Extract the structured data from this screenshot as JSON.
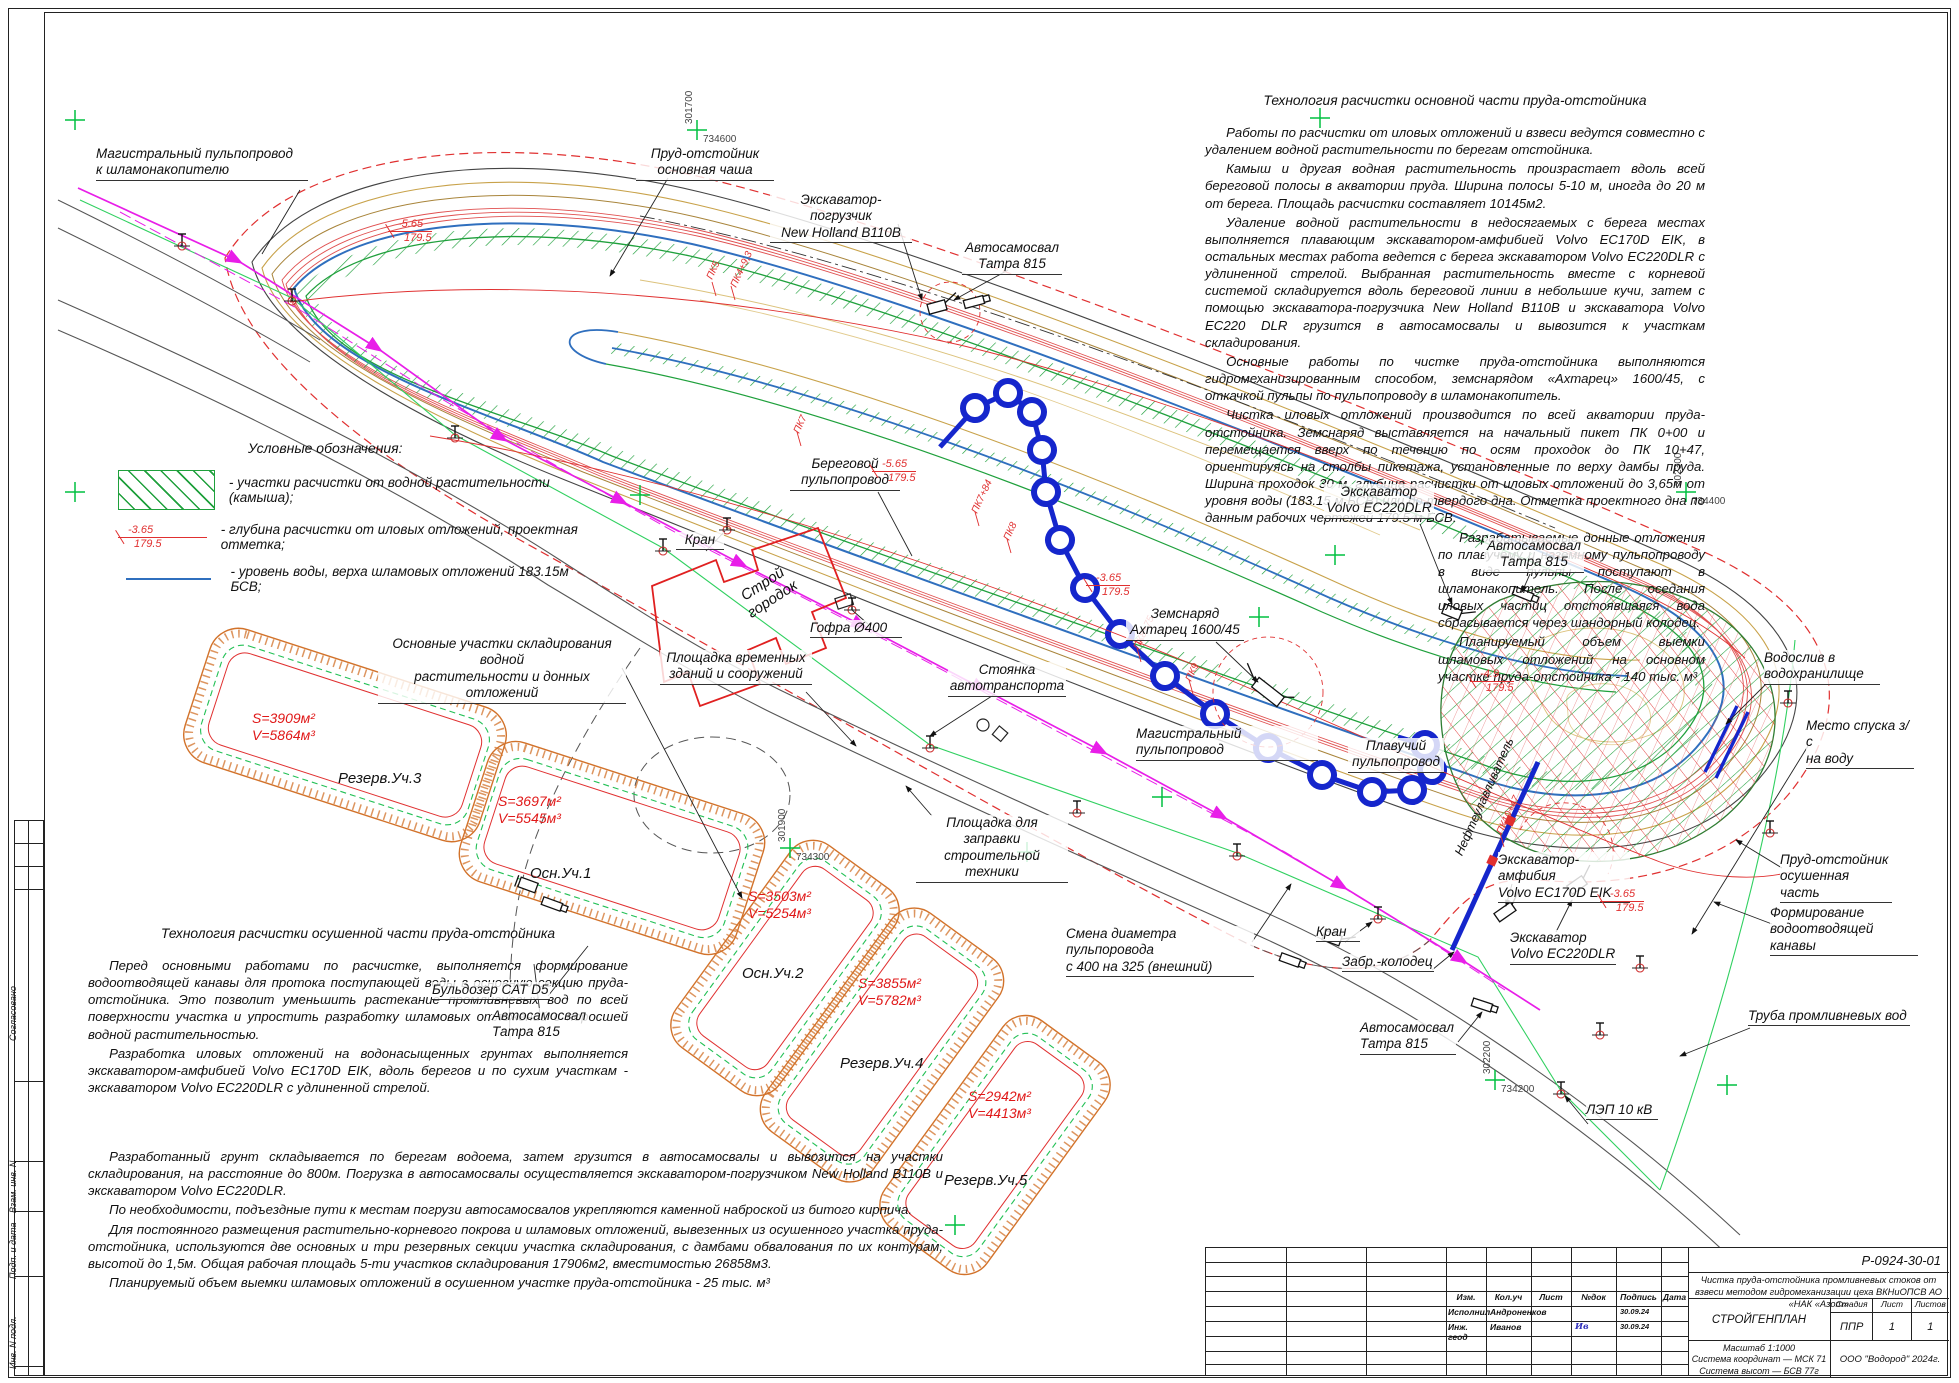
{
  "sheet": {
    "doc_number": "Р-0924-30-01"
  },
  "tech_main": {
    "title": "Технология расчистки основной части пруда-отстойника",
    "p1": "Работы по расчистки от иловых отложений и взвеси ведутся совместно с удалением водной растительности по берегам отстойника.",
    "p2": "Камыш и другая водная растительность произрастает вдоль всей береговой полосы в акватории пруда. Ширина полосы 5-10 м, иногда до 20 м от берега. Площадь расчистки составляет 10145м2.",
    "p3": "Удаление водной растительности в недосягаемых с берега местах выполняется плавающим экскаватором-амфибией Volvo EC170D EIK, в остальных местах работа ведется с берега экскаватором Volvo EC220DLR с удлиненной стрелой. Выбранная растительность вместе с корневой системой складируется вдоль береговой линии в небольшие кучи, затем с помощью экскаватора-погрузчика New Holland B110B и экскаватора Volvo EC220 DLR грузится в автосамосвалы и вывозится к участкам складирования.",
    "p4": "Основные работы по чистке пруда-отстойника выполняются гидромеханизированным способом, земснарядом «Ахтарец» 1600/45, с откачкой пульпы по пульпопроводу в шламонакопитель.",
    "p5": "Чистка иловых отложений производится по всей акватории пруда-отстойника. Земснаряд выставляется на начальный пикет ПК 0+00 и перемещается вверх по течению по осям проходок до ПК 10+47, ориентируясь на столбы пикетажа, установленные по верху дамбы пруда. Ширина проходок 30 м, глубина расчистки от иловых отложений до 3,65м от уровня воды (183.15 м БСВ) или до твердого дна. Отметка проектного дна по данным рабочих чертежей 179.5 м БСВ.",
    "p6": "Разрабатываемые донные отложения по плавучему и наземному пульпопроводу в виде пульпы поступают в шламонакопитель. После оседания иловых частиц отстоявшаяся вода сбрасывается через шандорный колодец.",
    "p7": "Планируемый объем выемки шламовых отложений на основном участке пруда-отстойника - 140 тыс. м³"
  },
  "tech_dry": {
    "title": "Технология расчистки осушенной части пруда-отстойника",
    "p1": "Перед основными работами по расчистке, выполняется формирование водоотводящей канавы для протока поступающей воды в основную секцию пруда-отстойника. Это позволит уменьшить растекание промливневых вод по всей поверхности участка и упростить разработку шламовых отложений с поросшей водной растительностью.",
    "p2": "Разработка иловых отложений на водонасыщенных грунтах выполняется экскаватором-амфибией Volvo EC170D EIK, вдоль берегов и по сухим участкам - экскаватором Volvo EC220DLR с удлиненной стрелой.",
    "p3": "Разработанный грунт складывается по берегам водоема, затем грузится в автосамосвалы и вывозится на участки складирования, на расстояние до 800м. Погрузка в автосамосвалы осуществляется экскаватором-погрузчиком New Holland B110B и экскаватором Volvo EC220DLR.",
    "p4": "По необходимости, подъездные пути к местам погрузи автосамосвалов укрепляются каменной наброской из битого кирпича.",
    "p5": "Для постоянного размещения растительно-корневого покрова и шламовых отложений, вывезенных из осушенного участка пруда-отстойника, используются две основных и три резервных секции участка складирования, с дамбами обвалования по их контурам, высотой до 1,5м. Общая рабочая площадь 5-ти участков складирования 17906м2, вместимостью 26858м3.",
    "p6": "Планируемый объем выемки шламовых отложений в осушенном участке пруда-отстойника - 25 тыс. м³"
  },
  "legend": {
    "title": "Условные обозначения:",
    "item1": "- участки расчистки от водной растительности (камыша);",
    "item2": "- глубина расчистки от иловых отложений,  проектная отметка;",
    "item3": "- уровень воды, верха шламовых отложений 183.15м БСВ;",
    "depth_value": "-3.65",
    "depth_elev": "179.5"
  },
  "callouts": {
    "c0": "Магистральный пульпопровод\nк шламонакопителю",
    "c1": "Пруд-отстойник\nосновная чаша",
    "c2": "Экскаватор-погрузчик\nNew Holland B110B",
    "c3": "Автосамосвал\nТатра 815",
    "c4": "Береговой\nпульпопровод",
    "c5": "Кран",
    "c6": "Гофра Ø400",
    "c7": "Площадка временных\nзданий и сооружений",
    "c8": "Стоянка\nавтотранспорта",
    "c9": "Строй\nгородок",
    "c10": "Площадка для заправки\nстроительной техники",
    "c11": "Основные участки складирования водной\nрастительности и донных отложений",
    "c12": "Земснаряд\nАхтарец 1600/45",
    "c13": "Магистральный пульпопровод",
    "c14": "Плавучий\nпульпопровод",
    "c15": "Экскаватор\nVolvo EC220DLR",
    "c16": "Автосамосвал\nТатра 815",
    "c17": "Водослив в\nводохранилище",
    "c18": "Место спуска з/с\nна воду",
    "c19": "Пруд-отстойник\nосушенная часть",
    "c20": "Формирование\nводоотводящей канавы",
    "c21": "Экскаватор-амфибия\nVolvo EC170D EIK",
    "c22": "Экскаватор\nVolvo EC220DLR",
    "c23": "Труба промливневых вод",
    "c24": "ЛЭП 10 кВ",
    "c25": "Автосамосвал\nТатра 815",
    "c26": "Смена диаметра пульпоровода\nс 400 на 325 (внешний)",
    "c27": "Забр.-колодец",
    "c28": "Бульдозер CAT D5",
    "c29": "Автосамосвал\nТатра 815",
    "c30": "Кран",
    "c31": "Нефтеулавливатель"
  },
  "parcels": [
    {
      "name": "Резерв.Уч.3",
      "sv": "S=3909м²\nV=5864м³"
    },
    {
      "name": "Осн.Уч.1",
      "sv": "S=3697м²\nV=5545м³"
    },
    {
      "name": "Осн.Уч.2",
      "sv": "S=3503м²\nV=5254м³"
    },
    {
      "name": "Резерв.Уч.4",
      "sv": "S=3855м²\nV=5782м³"
    },
    {
      "name": "Резерв.Уч.5",
      "sv": "S=2942м²\nV=4413м³"
    }
  ],
  "depth_marks": [
    {
      "v": "-5.65",
      "e": "179.5"
    },
    {
      "v": "-5.65",
      "e": "179.5"
    },
    {
      "v": "-3.65",
      "e": "179.5"
    },
    {
      "v": "-4.9",
      "e": "179.5"
    },
    {
      "v": "-3.65",
      "e": "179.5"
    }
  ],
  "pikets": [
    "ПК5",
    "ПК4+9,3",
    "ПК7",
    "ПК7+84",
    "ПК8",
    "ПК8+75",
    "ПК9",
    "ПК10+47"
  ],
  "grid": [
    {
      "e": "301700",
      "n": "734600"
    },
    {
      "e": "301900",
      "n": "734300"
    },
    {
      "e": "302200",
      "n": "734200"
    },
    {
      "e": "302300",
      "n": "734400"
    }
  ],
  "title_block": {
    "doc_number": "Р-0924-30-01",
    "project": "Чистка пруда-отстойника промливневых стоков от взвеси методом гидромеханизации цеха ВКНиОПСВ АО «НАК «Азот»",
    "drawing": "СТРОЙГЕНПЛАН",
    "col_izm": "Изм.",
    "col_koluch": "Кол.уч",
    "col_list": "Лист",
    "col_ndok": "№док",
    "col_podpis": "Подпись",
    "col_data": "Дата",
    "row1_role": "Исполнил",
    "row1_name": "Андроненков",
    "row1_date": "30.09.24",
    "row2_role": "Инж. геод",
    "row2_name": "Иванов",
    "row2_sign": "Ив",
    "row2_date": "30.09.24",
    "stage_label": "Стадия",
    "sheet_label": "Лист",
    "sheets_label": "Листов",
    "stage": "ППР",
    "sheet": "1",
    "sheets": "1",
    "scale": "Масштаб 1:1000",
    "coord_system": "Система координат — МСК 71",
    "height_system": "Система высот — БСВ 77г",
    "org": "ООО \"Водород\" 2024г."
  },
  "frame_strip": {
    "s1": "Согласовано",
    "s2": "Взам. инв. N",
    "s3": "Подп. и дата",
    "s4": "Инв. N подл."
  },
  "colors": {
    "water_blue": "#2f6fbe",
    "pipeline_blue": "#1526cc",
    "reed_green": "#1fa03c",
    "boundary_red": "#e03030",
    "pulp_magenta": "#e81ee8",
    "parcel_orange": "#d2722a",
    "lep_green": "#30d060",
    "grid_green": "#00c040",
    "contour_brown": "#c8a24a"
  }
}
